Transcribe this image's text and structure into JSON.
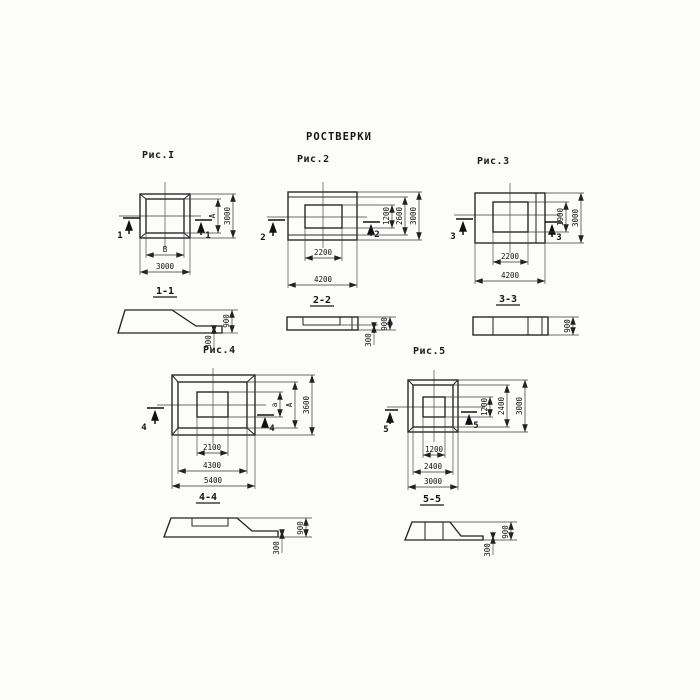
{
  "title": "РОСТВЕРКИ",
  "fig1": {
    "caption": "Рис.I",
    "cut": "1",
    "section_label": "1-1",
    "dim_inner_width": "В",
    "dim_outer_width": "3000",
    "dim_inner_height": "А",
    "dim_outer_height": "3000"
  },
  "fig2": {
    "caption": "Рис.2",
    "cut": "2",
    "section_label": "2-2",
    "dim_inner_width": "2200",
    "dim_outer_width": "4200",
    "dim_inner_height": "1200",
    "dim_mid_height": "2600",
    "dim_outer_height": "3000"
  },
  "fig3": {
    "caption": "Рис.3",
    "cut": "3",
    "section_label": "3-3",
    "dim_inner_width": "2200",
    "dim_outer_width": "4200",
    "dim_inner_height": "1900",
    "dim_outer_height": "3000"
  },
  "fig4": {
    "caption": "Рис.4",
    "cut": "4",
    "section_label": "4-4",
    "dim_inner_width": "2100",
    "dim_mid_width": "4300",
    "dim_outer_width": "5400",
    "dim_inner_height": "а",
    "dim_mid_height": "А",
    "dim_outer_height": "3600"
  },
  "fig5": {
    "caption": "Рис.5",
    "cut": "5",
    "section_label": "5-5",
    "dim_inner_width": "1200",
    "dim_mid_width": "2400",
    "dim_outer_width": "3000",
    "dim_inner_height": "1200",
    "dim_mid_height": "2400",
    "dim_outer_height": "3000"
  },
  "sections": {
    "s1": {
      "height": "900",
      "edge": "300"
    },
    "s2": {
      "height": "900",
      "edge": "300"
    },
    "s3": {
      "height": "900"
    },
    "s4": {
      "height": "900",
      "edge": "300"
    },
    "s5": {
      "height": "900",
      "edge": "300"
    }
  }
}
